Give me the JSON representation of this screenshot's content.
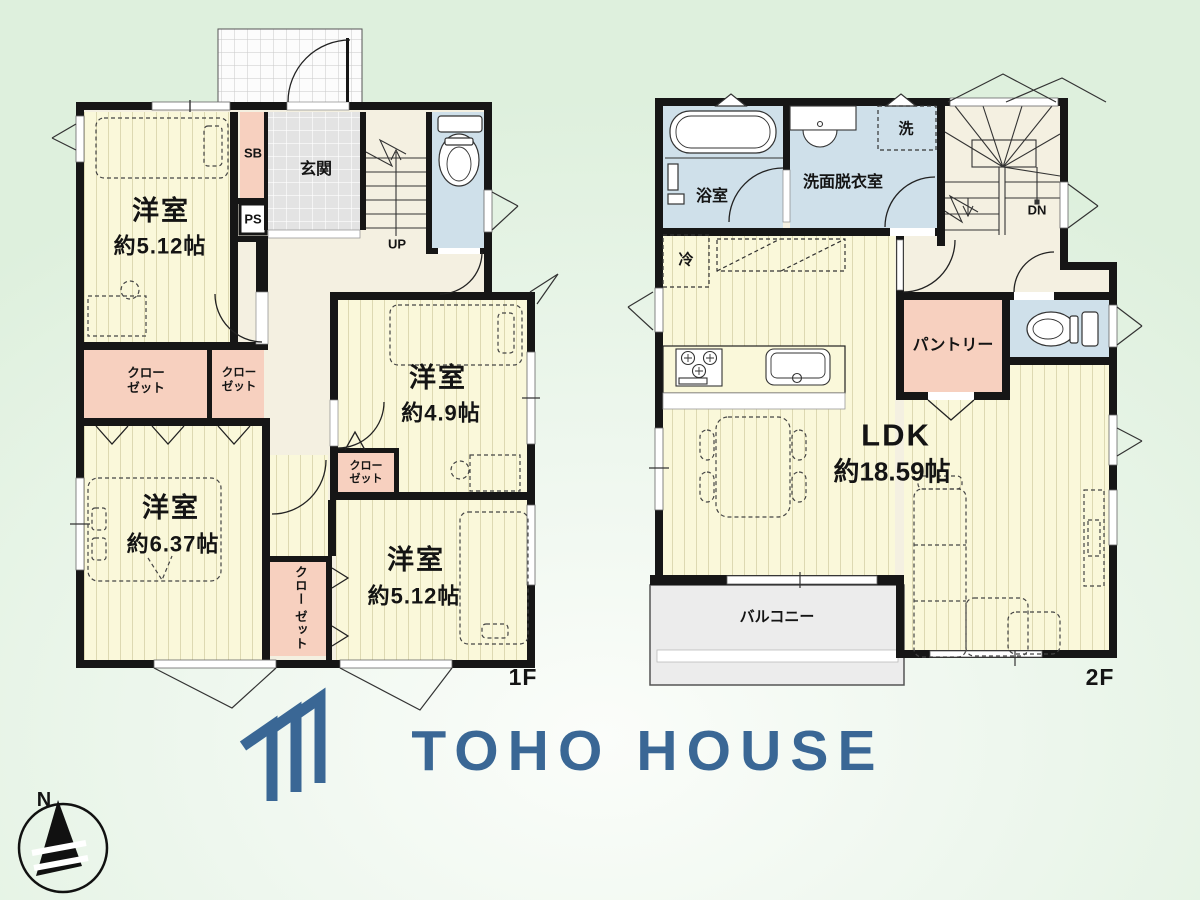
{
  "floor1": {
    "label": "1F",
    "rooms": [
      {
        "name": "洋室",
        "area": "約5.12帖"
      },
      {
        "name": "洋室",
        "area": "約4.9帖"
      },
      {
        "name": "洋室",
        "area": "約6.37帖"
      },
      {
        "name": "洋室",
        "area": "約5.12帖"
      }
    ],
    "entrance": "玄関",
    "shoe_box": "SB",
    "pipe_space": "PS",
    "stairs_up": "UP"
  },
  "floor2": {
    "label": "2F",
    "bath": "浴室",
    "washroom": "洗面脱衣室",
    "washer": "洗",
    "fridge": "冷",
    "pantry": "パントリー",
    "ldk": {
      "name": "LDK",
      "area": "約18.59帖"
    },
    "balcony": "バルコニー",
    "stairs_down": "DN"
  },
  "closet": {
    "line1": "クロー",
    "line2": "ゼット"
  },
  "logo": {
    "text": "TOHO HOUSE",
    "color": "#3a6795"
  },
  "compass": {
    "north": "N"
  },
  "palette": {
    "room_floor": "#faf8da",
    "wet_area": "#cfe0ea",
    "storage": "#f7d0bf",
    "hall": "#f4f0e1",
    "balcony": "#ececec",
    "wall": "#161616"
  }
}
